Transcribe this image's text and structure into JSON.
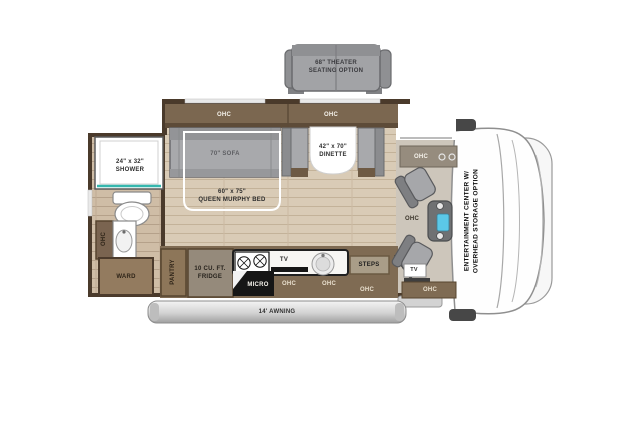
{
  "meta": {
    "type": "rv-floorplan-diagram"
  },
  "colors": {
    "wall": "#4a3a2b",
    "cabinet": "#7f6b53",
    "cabinet_dark": "#5d4b38",
    "floor": "#d9cbb6",
    "upholstery": "#a4a5a8",
    "shower_accent": "#35b7ae",
    "awning_silver": "#c9c9c9"
  },
  "theater_option": {
    "size_line": "68\" THEATER",
    "name_line": "SEATING OPTION"
  },
  "overhead": {
    "top_left": "OHC",
    "top_right": "OHC",
    "vanity": "OHC",
    "kitchen_left": "OHC",
    "kitchen_right": "OHC",
    "entry": "OHC",
    "cab_dash": "OHC",
    "cab_console": "OHC",
    "cab_rear": "OHC"
  },
  "bathroom": {
    "shower_size": "24\" x 32\"",
    "shower_name": "SHOWER",
    "ward": "WARD"
  },
  "bedroom": {
    "sofa": "70\" SOFA",
    "bed_size": "60\" x 75\"",
    "bed_name": "QUEEN MURPHY BED"
  },
  "dinette": {
    "size": "42\" x 70\"",
    "name": "DINETTE"
  },
  "kitchen": {
    "pantry": "PANTRY",
    "fridge_size": "10 CU. FT.",
    "fridge_name": "FRIDGE",
    "micro": "MICRO",
    "tv": "TV"
  },
  "entry": {
    "steps": "STEPS"
  },
  "cab": {
    "tv": "TV",
    "entertainment_line1": "ENTERTAINMENT CENTER W/",
    "entertainment_line2": "OVERHEAD STORAGE OPTION"
  },
  "exterior": {
    "awning": "14' AWNING"
  }
}
